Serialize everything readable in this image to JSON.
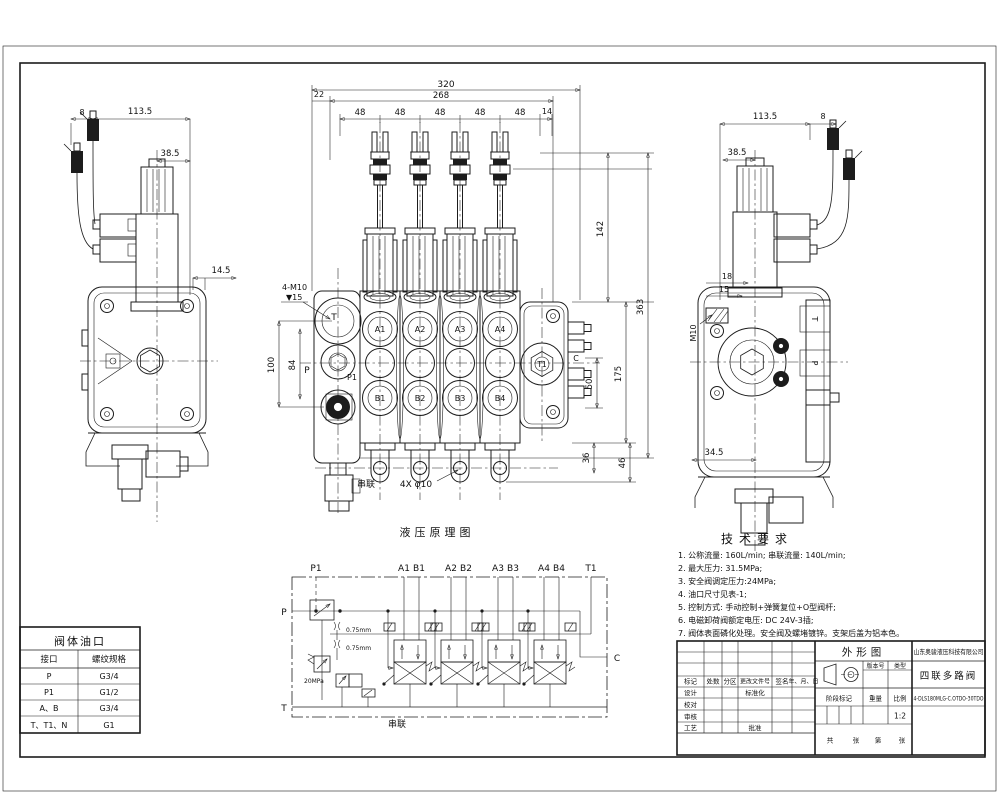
{
  "front_view": {
    "dims": {
      "w320": "320",
      "w268": "268",
      "w22": "22",
      "w48": [
        "48",
        "48",
        "48",
        "48",
        "48"
      ],
      "w14": "14",
      "h142": "142",
      "h363": "363",
      "h175": "175",
      "h50": "50",
      "h36": "36",
      "h46": "46",
      "h100": "100",
      "h84": "84"
    },
    "labels": {
      "port_T": "T",
      "port_P": "P",
      "port_P1": "P1",
      "port_T1": "T1",
      "port_C": "C",
      "A": [
        "A1",
        "A2",
        "A3",
        "A4"
      ],
      "B": [
        "B1",
        "B2",
        "B3",
        "B4"
      ],
      "series": "串联",
      "holes": "4X φ10",
      "thread": "4-M10",
      "depth": "▼15"
    }
  },
  "left_view": {
    "dims": {
      "d8": "8",
      "d113": "113.5",
      "d38": "38.5",
      "d14": "14.5"
    }
  },
  "right_view": {
    "dims": {
      "d113": "113.5",
      "d8": "8",
      "d38": "38.5",
      "d18": "18",
      "d15": "15",
      "m10": "M10",
      "d34": "34.5"
    },
    "labels": {
      "port_T": "T",
      "port_P": "P"
    }
  },
  "schematic": {
    "title": "液压原理图",
    "ports": {
      "P1": "P1",
      "A1": "A1",
      "B1": "B1",
      "A2": "A2",
      "B2": "B2",
      "A3": "A3",
      "B3": "B3",
      "A4": "A4",
      "B4": "B4",
      "T1": "T1",
      "P": "P",
      "T": "T",
      "C": "C"
    },
    "annotations": {
      "orifice": "0.75mm",
      "relief": "20MPa",
      "series": "串联"
    }
  },
  "tech_requirements": {
    "title": "技术要求",
    "lines": [
      "1. 公称流量: 160L/min; 串联流量: 140L/min;",
      "2. 最大压力: 31.5MPa;",
      "3. 安全阀调定压力:24MPa;",
      "4. 油口尺寸见表-1;",
      "5. 控制方式: 手动控制+弹簧复位+O型阀杆;",
      "6. 电磁卸荷阀额定电压: DC 24V-3插;",
      "7. 阀体表面磷化处理。安全阀及螺堵镀锌。支架后盖为铝本色。"
    ]
  },
  "port_table": {
    "title": "阀体油口",
    "headers": [
      "接口",
      "螺纹规格"
    ],
    "rows": [
      [
        "P",
        "G3/4"
      ],
      [
        "P1",
        "G1/2"
      ],
      [
        "A、B",
        "G3/4"
      ],
      [
        "T、T1、N",
        "G1"
      ]
    ]
  },
  "title_block": {
    "drawing_type": "外形图",
    "company": "山东奥骏液压科技有限公司",
    "product": "四联多路阀",
    "part_number": "4-DLS180MLG-C.OTDO-30TDO",
    "scale_value": "1:2",
    "labels": {
      "mark": "标记",
      "count": "处数",
      "zone": "分区",
      "file_no": "更改文件号",
      "sign": "签名",
      "date": "年、月、日",
      "design": "设计",
      "standardize": "标准化",
      "check": "校对",
      "audit": "审核",
      "process": "工艺",
      "approve": "批准",
      "stage_mark": "阶段标记",
      "weight": "重量",
      "scale": "比例",
      "version": "版本号",
      "type": "类型",
      "total": "共",
      "sheets": "张",
      "page_no": "第",
      "sheets2": "张"
    }
  }
}
